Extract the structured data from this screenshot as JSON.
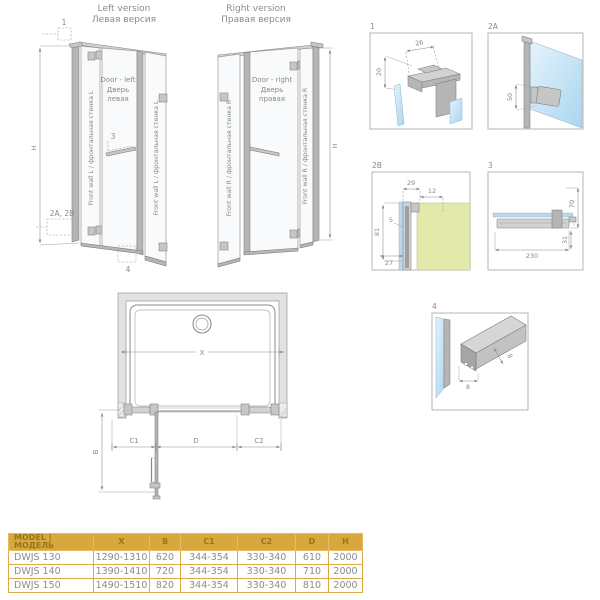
{
  "header": {
    "left_title_en": "Left version",
    "left_title_ru": "Левая версия",
    "right_title_en": "Right version",
    "right_title_ru": "Правая версия"
  },
  "left_version": {
    "front_wall_label": "Front wall L / фронтальная стенка L",
    "door_line1": "Door - left",
    "door_line2": "Дверь",
    "door_line3": "левая",
    "marker_top": "1",
    "marker_handle": "3",
    "marker_bottom": "4",
    "marker_side": "2A, 2B",
    "dim_height": "H"
  },
  "right_version": {
    "front_wall_label": "Front wall R / фронтальная стенка R",
    "door_line1": "Door - right",
    "door_line2": "Дверь",
    "door_line3": "правая",
    "dim_height": "H"
  },
  "details": {
    "d1": {
      "label": "1",
      "dim_width": "26",
      "dim_height": "20"
    },
    "d2a": {
      "label": "2A",
      "dim_hinge": "50"
    },
    "d2b": {
      "label": "2B",
      "dim_profile": "29",
      "dim_offset": "12",
      "dim_glass": "5",
      "dim_height": "81",
      "dim_base": "27"
    },
    "d3": {
      "label": "3",
      "dim_height": "70",
      "dim_drop": "31",
      "dim_length": "230"
    },
    "d4": {
      "label": "4",
      "dim_width": "8",
      "dim_height": "8"
    }
  },
  "plan": {
    "dim_x": "X",
    "dim_b": "B",
    "dim_c1": "C1",
    "dim_d": "D",
    "dim_c2": "C2"
  },
  "table": {
    "headers": [
      "MODEL  |  МОДЕЛЬ",
      "X",
      "B",
      "C1",
      "C2",
      "D",
      "H"
    ],
    "rows": [
      [
        "DWJS 130",
        "1290-1310",
        "620",
        "344-354",
        "330-340",
        "610",
        "2000"
      ],
      [
        "DWJS 140",
        "1390-1410",
        "720",
        "344-354",
        "330-340",
        "710",
        "2000"
      ],
      [
        "DWJS 150",
        "1490-1510",
        "820",
        "344-354",
        "330-340",
        "810",
        "2000"
      ]
    ]
  },
  "colors": {
    "table_header_bg": "#d8a73e",
    "table_header_text": "#97761d",
    "table_border": "#d9ab4a",
    "cell_text": "#8c8c8c",
    "line_gray": "#8a8a8a",
    "glass_blue": "#bcd9ec",
    "wall_section_green": "#e3e8ab"
  }
}
